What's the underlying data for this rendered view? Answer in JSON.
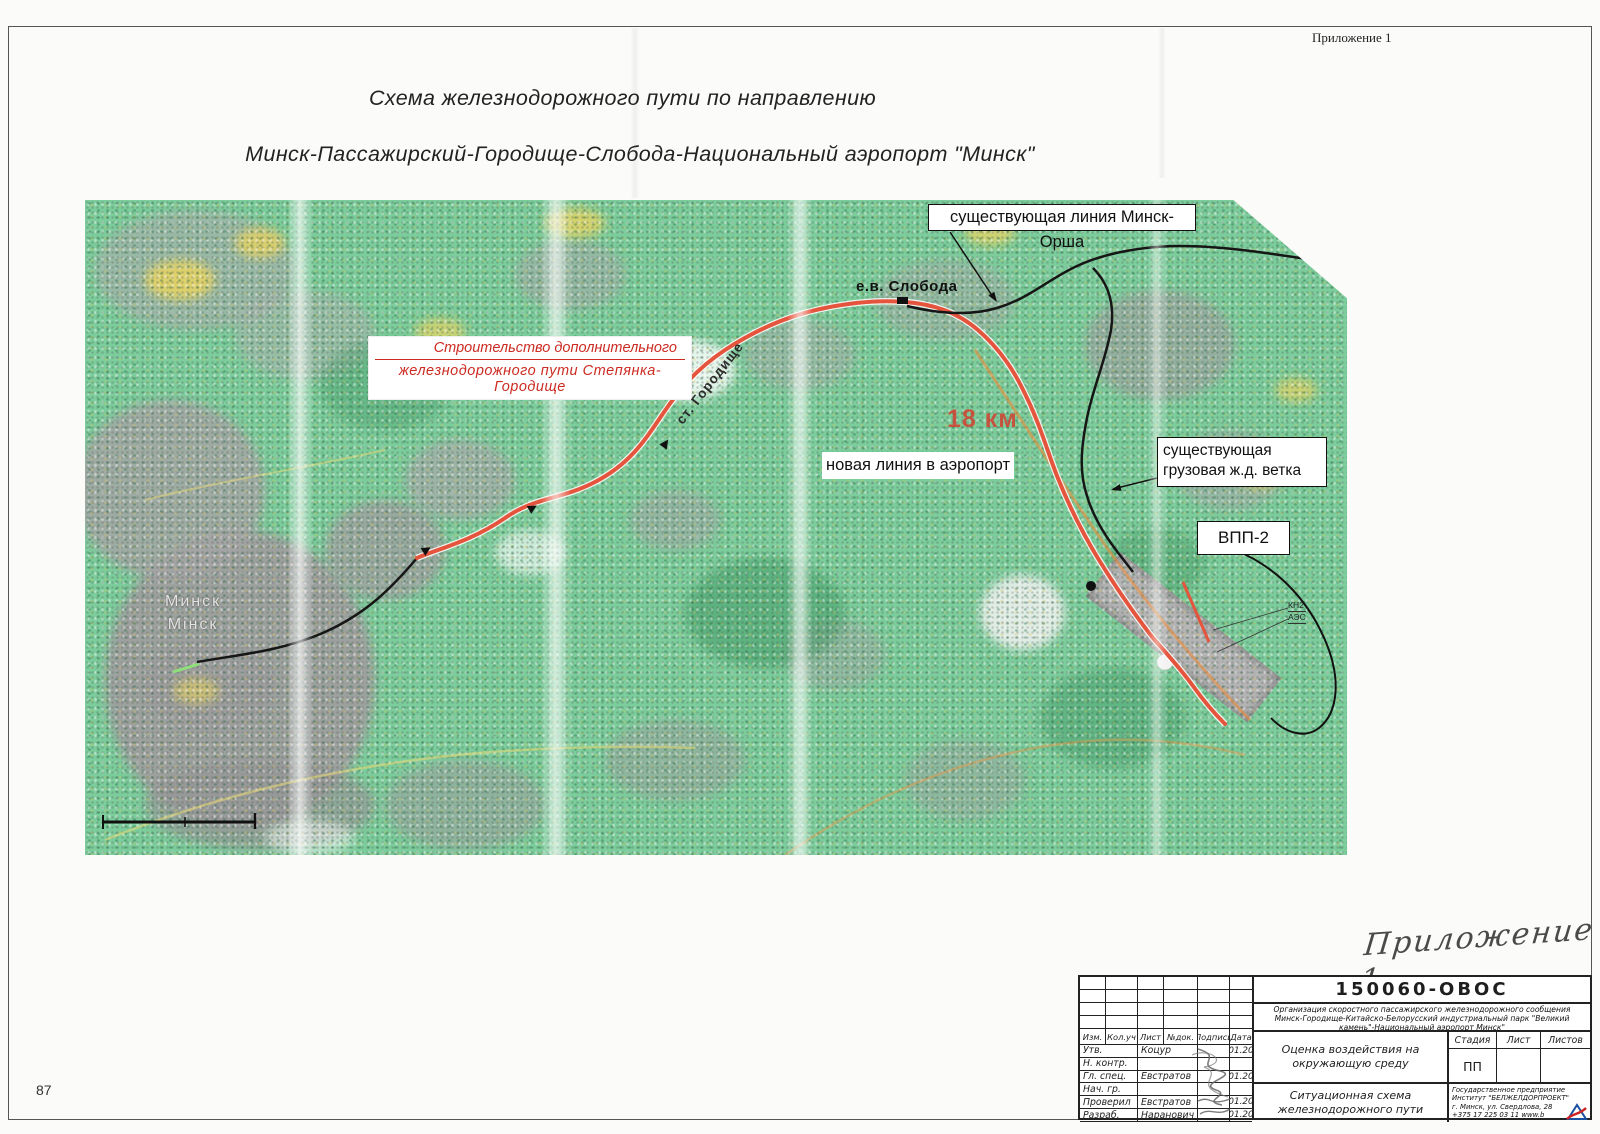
{
  "page": {
    "appendix_note_top": "Приложение 1",
    "title_line1": "Схема железнодорожного пути по направлению",
    "title_line2": "Минск-Пассажирский-Городище-Слобода-Национальный аэропорт \"Минск\"",
    "page_number": "87",
    "handwritten_note": "Приложение 1"
  },
  "map": {
    "labels": {
      "existing_line": "существующая линия Минск-Орша",
      "sloboda_stop": "е.в. Слобода",
      "construction_line1": "Строительство дополнительного",
      "construction_line2": "железнодорожного пути Степянка-Городище",
      "gorodishche_station": "ст. Городище",
      "distance": "18 км",
      "new_line": "новая линия в аэропорт",
      "freight_line1": "существующая",
      "freight_line2": "грузовая ж.д. ветка",
      "runway": "ВПП-2",
      "city_ru": "Минск",
      "city_by": "Мінск",
      "note_kn2": "КН2",
      "note_aes": "АЭС"
    },
    "colors": {
      "new_route": "#e5543c",
      "existing_route": "#1a1a1a",
      "terrain_green": "#7bcd9b"
    }
  },
  "title_block": {
    "doc_number": "150060-ОВОС",
    "project_description_line1": "Организация скоростного пассажирского железнодорожного сообщения",
    "project_description_line2": "Минск-Городище-Китайско-Белорусский индустриальный парк \"Великий",
    "project_description_line3": "камень\"-Национальный аэропорт  Минск\"",
    "header_cols": [
      "Изм.",
      "Кол.уч",
      "Лист",
      "№док.",
      "Подпись",
      "Дата"
    ],
    "rows": [
      {
        "role": "Утв.",
        "name": "Коцур",
        "date": "01.20"
      },
      {
        "role": "Н. контр.",
        "name": "",
        "date": ""
      },
      {
        "role": "Гл. спец.",
        "name": "Евстратов",
        "date": "01.20"
      },
      {
        "role": "Нач. гр.",
        "name": "",
        "date": ""
      },
      {
        "role": "Проверил",
        "name": "Евстратов",
        "date": "01.20"
      },
      {
        "role": "Разраб.",
        "name": "Наранович",
        "date": "01.20"
      }
    ],
    "section_env1": "Оценка воздействия на",
    "section_env2": "окружающую среду",
    "section_scheme1": "Ситуационная схема",
    "section_scheme2": "железнодорожного пути",
    "stage_label": "Стадия",
    "sheet_label": "Лист",
    "sheets_label": "Листов",
    "stage_value": "ПП",
    "company_line1": "Государственное предприятие",
    "company_line2": "Институт \"БЕЛЖЕЛДОРПРОЕКТ\"",
    "company_line3": "г. Минск, ул. Свердлова, 28",
    "company_line4": "+375 17 225 03 11   www.b"
  }
}
